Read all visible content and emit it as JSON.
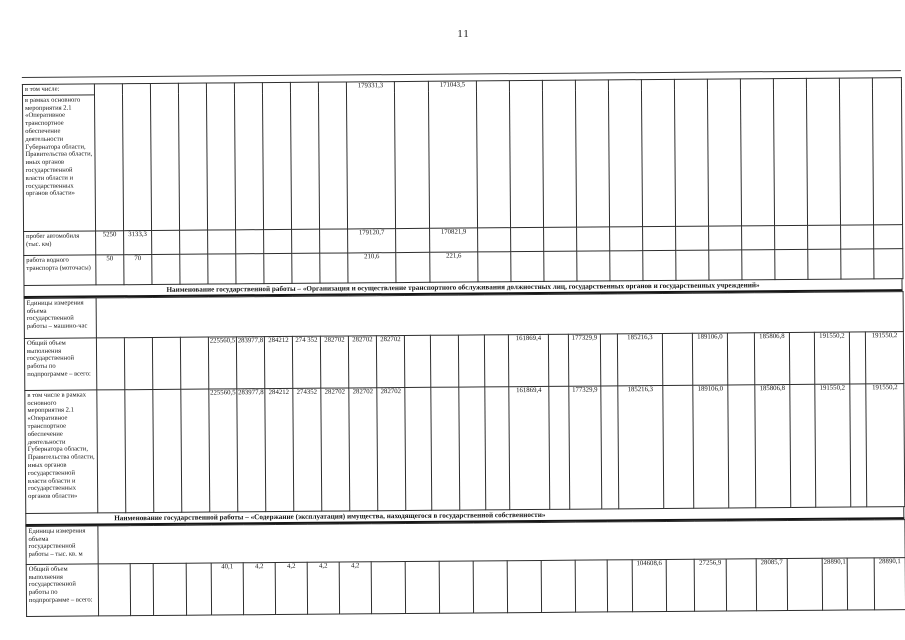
{
  "page": {
    "number": "11"
  },
  "document": {
    "sections": [
      {
        "name": "continuation-of-previous-table",
        "rows": [
          {
            "label": "в том числе:",
            "cells": {
              "10": "179331,3",
              "12": "171043,5"
            }
          },
          {
            "label": "в рамках основного мероприятия 2.1 «Оперативное транспортное обеспечение деятельности Губернатора области, Правительства области, иных органов государственной власти области и государственных органов области»",
            "cells": {}
          },
          {
            "label": "пробег автомобиля (тыс. км)",
            "cells": {
              "1": "5250",
              "2": "3133,3",
              "10": "179120,7",
              "12": "170821,9"
            }
          },
          {
            "label": "работа водного транспорта (моточасы)",
            "cells": {
              "1": "50",
              "2": "70",
              "10": "210,6",
              "12": "221,6"
            }
          }
        ],
        "footer": "Наименование государственной работы – «Организация и осуществление транспортного обслуживания должностных лиц, государственных органов и государственных учреждений»"
      },
      {
        "name": "state-work-transport-service",
        "rows": [
          {
            "label": "Единицы измерения объема государственной работы – машино-час",
            "cells": {}
          },
          {
            "label": "Общий объем выполнения государственной работы по подпрограмме – всего:",
            "cells": {
              "5": "225560,5",
              "6": "283977,8",
              "7": "284212",
              "8": "274 352",
              "9": "282702",
              "10": "282702",
              "11": "282702",
              "16": "161869,4",
              "18": "177329,9",
              "20": "185216,3",
              "22": "189106,0",
              "24": "185806,8",
              "26": "191550,2",
              "28": "191550,2"
            }
          },
          {
            "label": "в том числе в рамках основного мероприятия 2.1 «Оперативное транспортное обеспечение деятельности Губернатора области, Правительства области, иных органов государственной власти области и государственных органов области»",
            "cells": {
              "5": "225560,5",
              "6": "283977,8",
              "7": "284212",
              "8": "274352",
              "9": "282702",
              "10": "282702",
              "11": "282702",
              "16": "161869,4",
              "18": "177329,9",
              "20": "185216,3",
              "22": "189106,0",
              "24": "185806,8",
              "26": "191550,2",
              "28": "191550,2"
            }
          }
        ],
        "footer": "Наименование государственной работы – «Содержание (эксплуатация) имущества, находящегося в государственной собственности»"
      },
      {
        "name": "state-work-property-maintenance",
        "rows": [
          {
            "label": "Единицы измерения объема государственной работы – тыс. кв. м",
            "cells": {}
          },
          {
            "label": "Общий объем выполнения государственной работы по подпрограмме – всего:",
            "cells": {
              "5": "40,1",
              "6": "4,2",
              "7": "4,2",
              "8": "4,2",
              "9": "4,2",
              "18": "104608,6",
              "20": "27256,9",
              "22": "28085,7",
              "24": "28890,1",
              "26": "28890,1"
            }
          }
        ],
        "footer": ""
      }
    ]
  }
}
